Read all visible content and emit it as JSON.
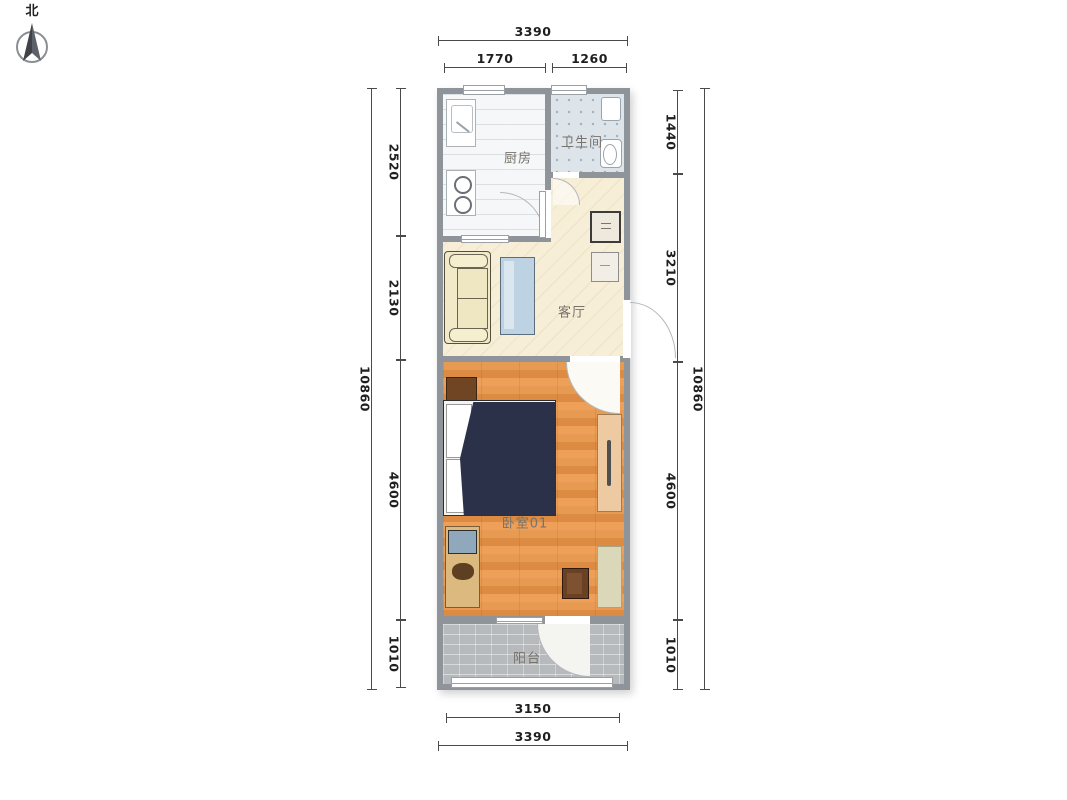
{
  "compass": {
    "north_label": "北"
  },
  "rooms": [
    {
      "id": "kitchen",
      "label": "厨房"
    },
    {
      "id": "bathroom",
      "label": "卫生间"
    },
    {
      "id": "living-room",
      "label": "客厅"
    },
    {
      "id": "bedroom",
      "label": "卧室01"
    },
    {
      "id": "balcony",
      "label": "阳台"
    }
  ],
  "dimensions": {
    "top": [
      {
        "name": "overall-width",
        "value": "3390"
      },
      {
        "name": "kitchen-width",
        "value": "1770"
      },
      {
        "name": "bathroom-width",
        "value": "1260"
      }
    ],
    "bottom": [
      {
        "name": "balcony-width",
        "value": "3150"
      },
      {
        "name": "overall-width",
        "value": "3390"
      }
    ],
    "left": {
      "overall": "10860",
      "segments": [
        {
          "name": "kitchen-depth",
          "value": "2520"
        },
        {
          "name": "living-room-depth",
          "value": "2130"
        },
        {
          "name": "bedroom-depth",
          "value": "4600"
        },
        {
          "name": "balcony-depth",
          "value": "1010"
        }
      ]
    },
    "right": {
      "overall": "10860",
      "segments": [
        {
          "name": "bathroom-depth",
          "value": "1440"
        },
        {
          "name": "living-room-depth",
          "value": "3210"
        },
        {
          "name": "bedroom-depth",
          "value": "4600"
        },
        {
          "name": "balcony-depth",
          "value": "1010"
        }
      ]
    }
  },
  "colors": {
    "wall": "#8e949a",
    "kitchen_floor": "#f5f7f8",
    "bathroom_floor": "#dde4ea",
    "living_floor": "#f6eed6",
    "bedroom_floor": "#e59550",
    "balcony_floor": "#b6babd",
    "bed_blanket": "#2b3149",
    "sofa": "#f1e9c8",
    "table": "#bdd2e2",
    "wood_dark": "#6f4524",
    "wardrobe": "#edcaa1",
    "dim_line": "#4a4a4a",
    "dim_text": "#1f1f1f",
    "room_label": "#77726a"
  }
}
